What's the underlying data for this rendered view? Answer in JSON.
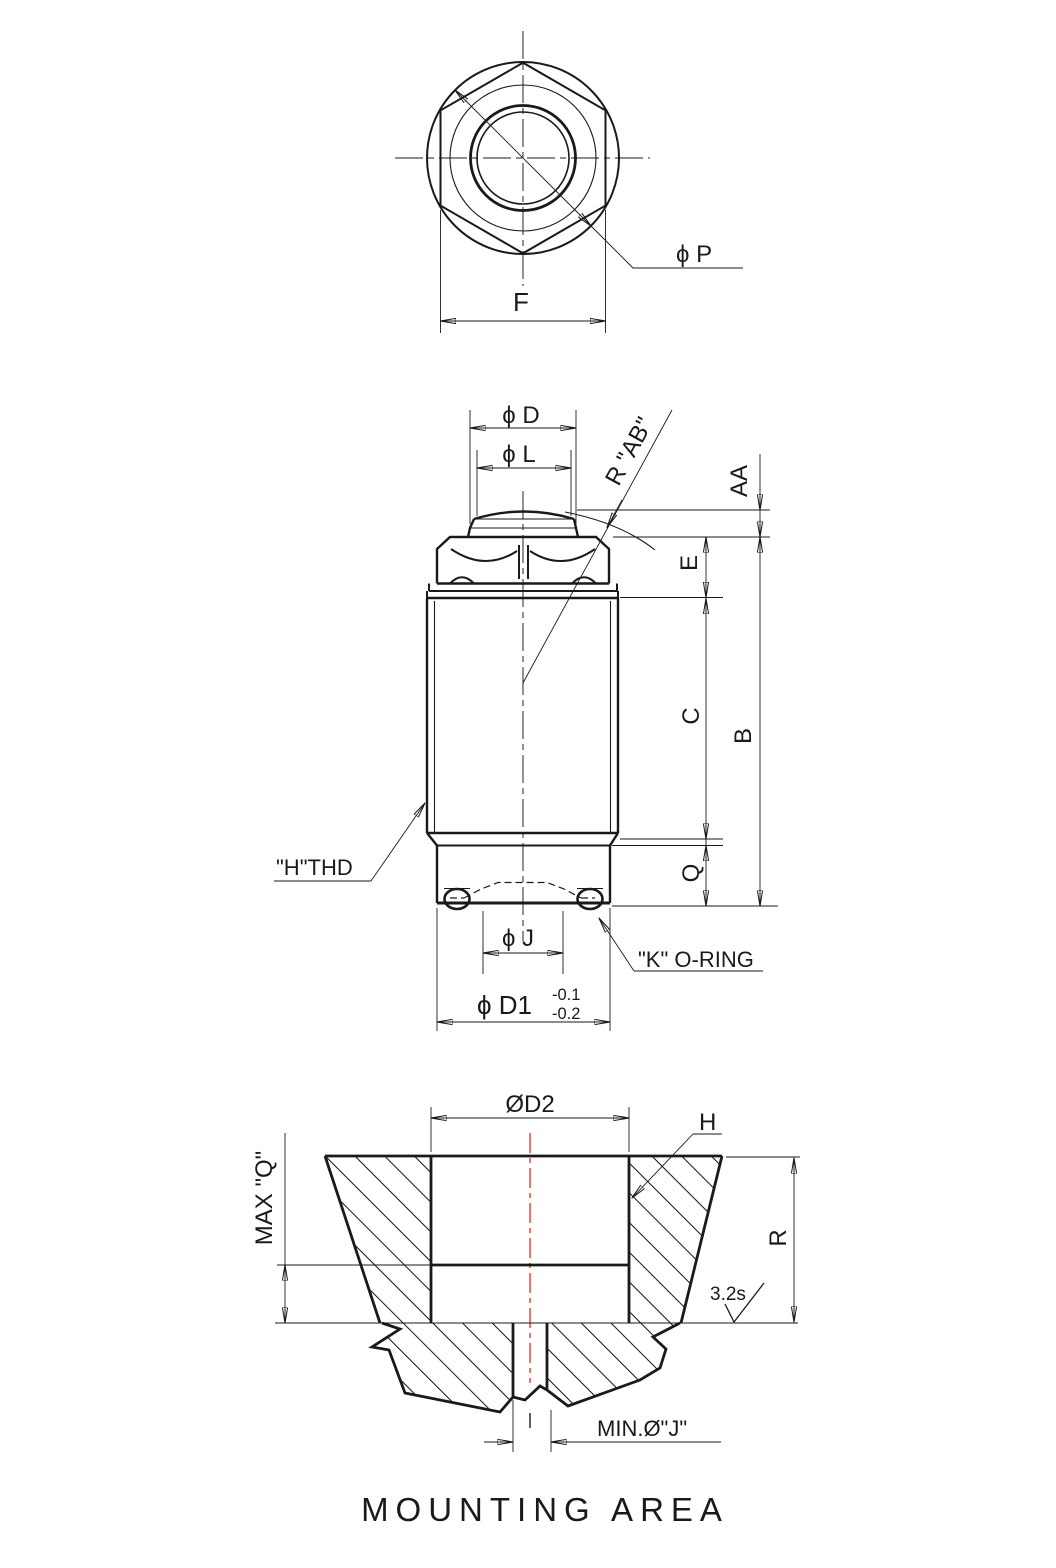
{
  "drawing": {
    "top_view": {
      "phi_p": "ϕ P",
      "f": "F"
    },
    "side_view": {
      "phi_d": "ϕ D",
      "phi_l": "ϕ L",
      "r_ab": "R \"AB\"",
      "aa": "AA",
      "e": "E",
      "c": "C",
      "b": "B",
      "q": "Q",
      "h_thd": "\"H\"THD",
      "phi_j": "ϕ J",
      "phi_d1": "ϕ D1",
      "d1_tol_upper": "-0.1",
      "d1_tol_lower": "-0.2",
      "k_oring": "\"K\" O-RING"
    },
    "mounting_view": {
      "d2": "ØD2",
      "h": "H",
      "max_q": "MAX \"Q\"",
      "r": "R",
      "surface_finish": "3.2s",
      "min_j": "MIN.Ø\"J\"",
      "title": "MOUNTING AREA"
    },
    "colors": {
      "line": "#1a1a1a",
      "centerline_red": "#e8392b"
    }
  }
}
